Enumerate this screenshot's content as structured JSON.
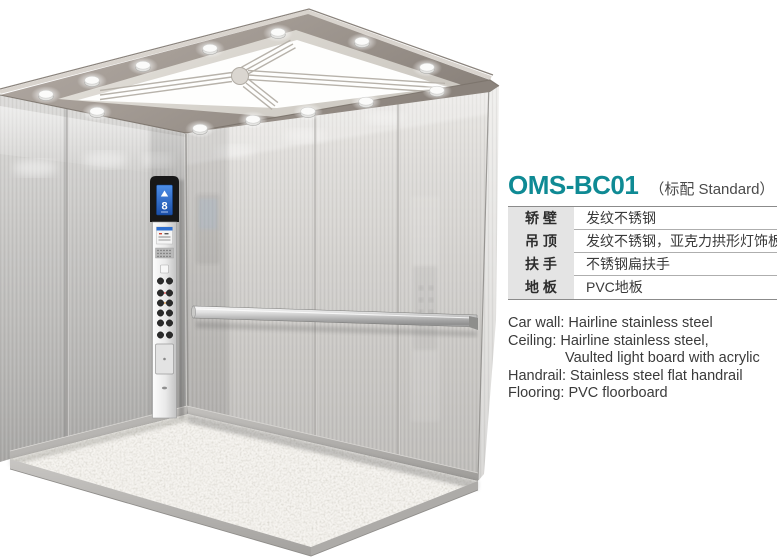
{
  "panel": {
    "model": "OMS-BC01",
    "variant": "（标配 Standard）",
    "spec_table": {
      "rows": [
        {
          "label": "轿 壁",
          "value": "发纹不锈钢"
        },
        {
          "label": "吊 顶",
          "value": "发纹不锈钢，亚克力拱形灯饰板"
        },
        {
          "label": "扶 手",
          "value": "不锈钢扁扶手"
        },
        {
          "label": "地 板",
          "value": "PVC地板"
        }
      ]
    },
    "spec_en": {
      "lines": [
        {
          "text": "Car wall: Hairline stainless steel",
          "indent": false
        },
        {
          "text": "Ceiling: Hairline stainless steel,",
          "indent": false
        },
        {
          "text": "Vaulted light board with acrylic",
          "indent": true
        },
        {
          "text": "Handrail: Stainless steel flat handrail",
          "indent": false
        },
        {
          "text": "Flooring: PVC floorboard",
          "indent": false
        }
      ]
    }
  },
  "elevator": {
    "cop": {
      "direction_arrow": "▲",
      "floor": "8"
    }
  },
  "colors": {
    "accent_teal": "#0f8a94",
    "label_cell_bg": "#e4e4e4",
    "table_border": "#8b8b8b",
    "body_text": "#3a3a3a",
    "ceiling_frame": "#a29a93",
    "wall_steel": "#cccac7",
    "cop_screen_blue": "#2e6fd0",
    "floor_speckle_base": "#f6f4f0"
  }
}
